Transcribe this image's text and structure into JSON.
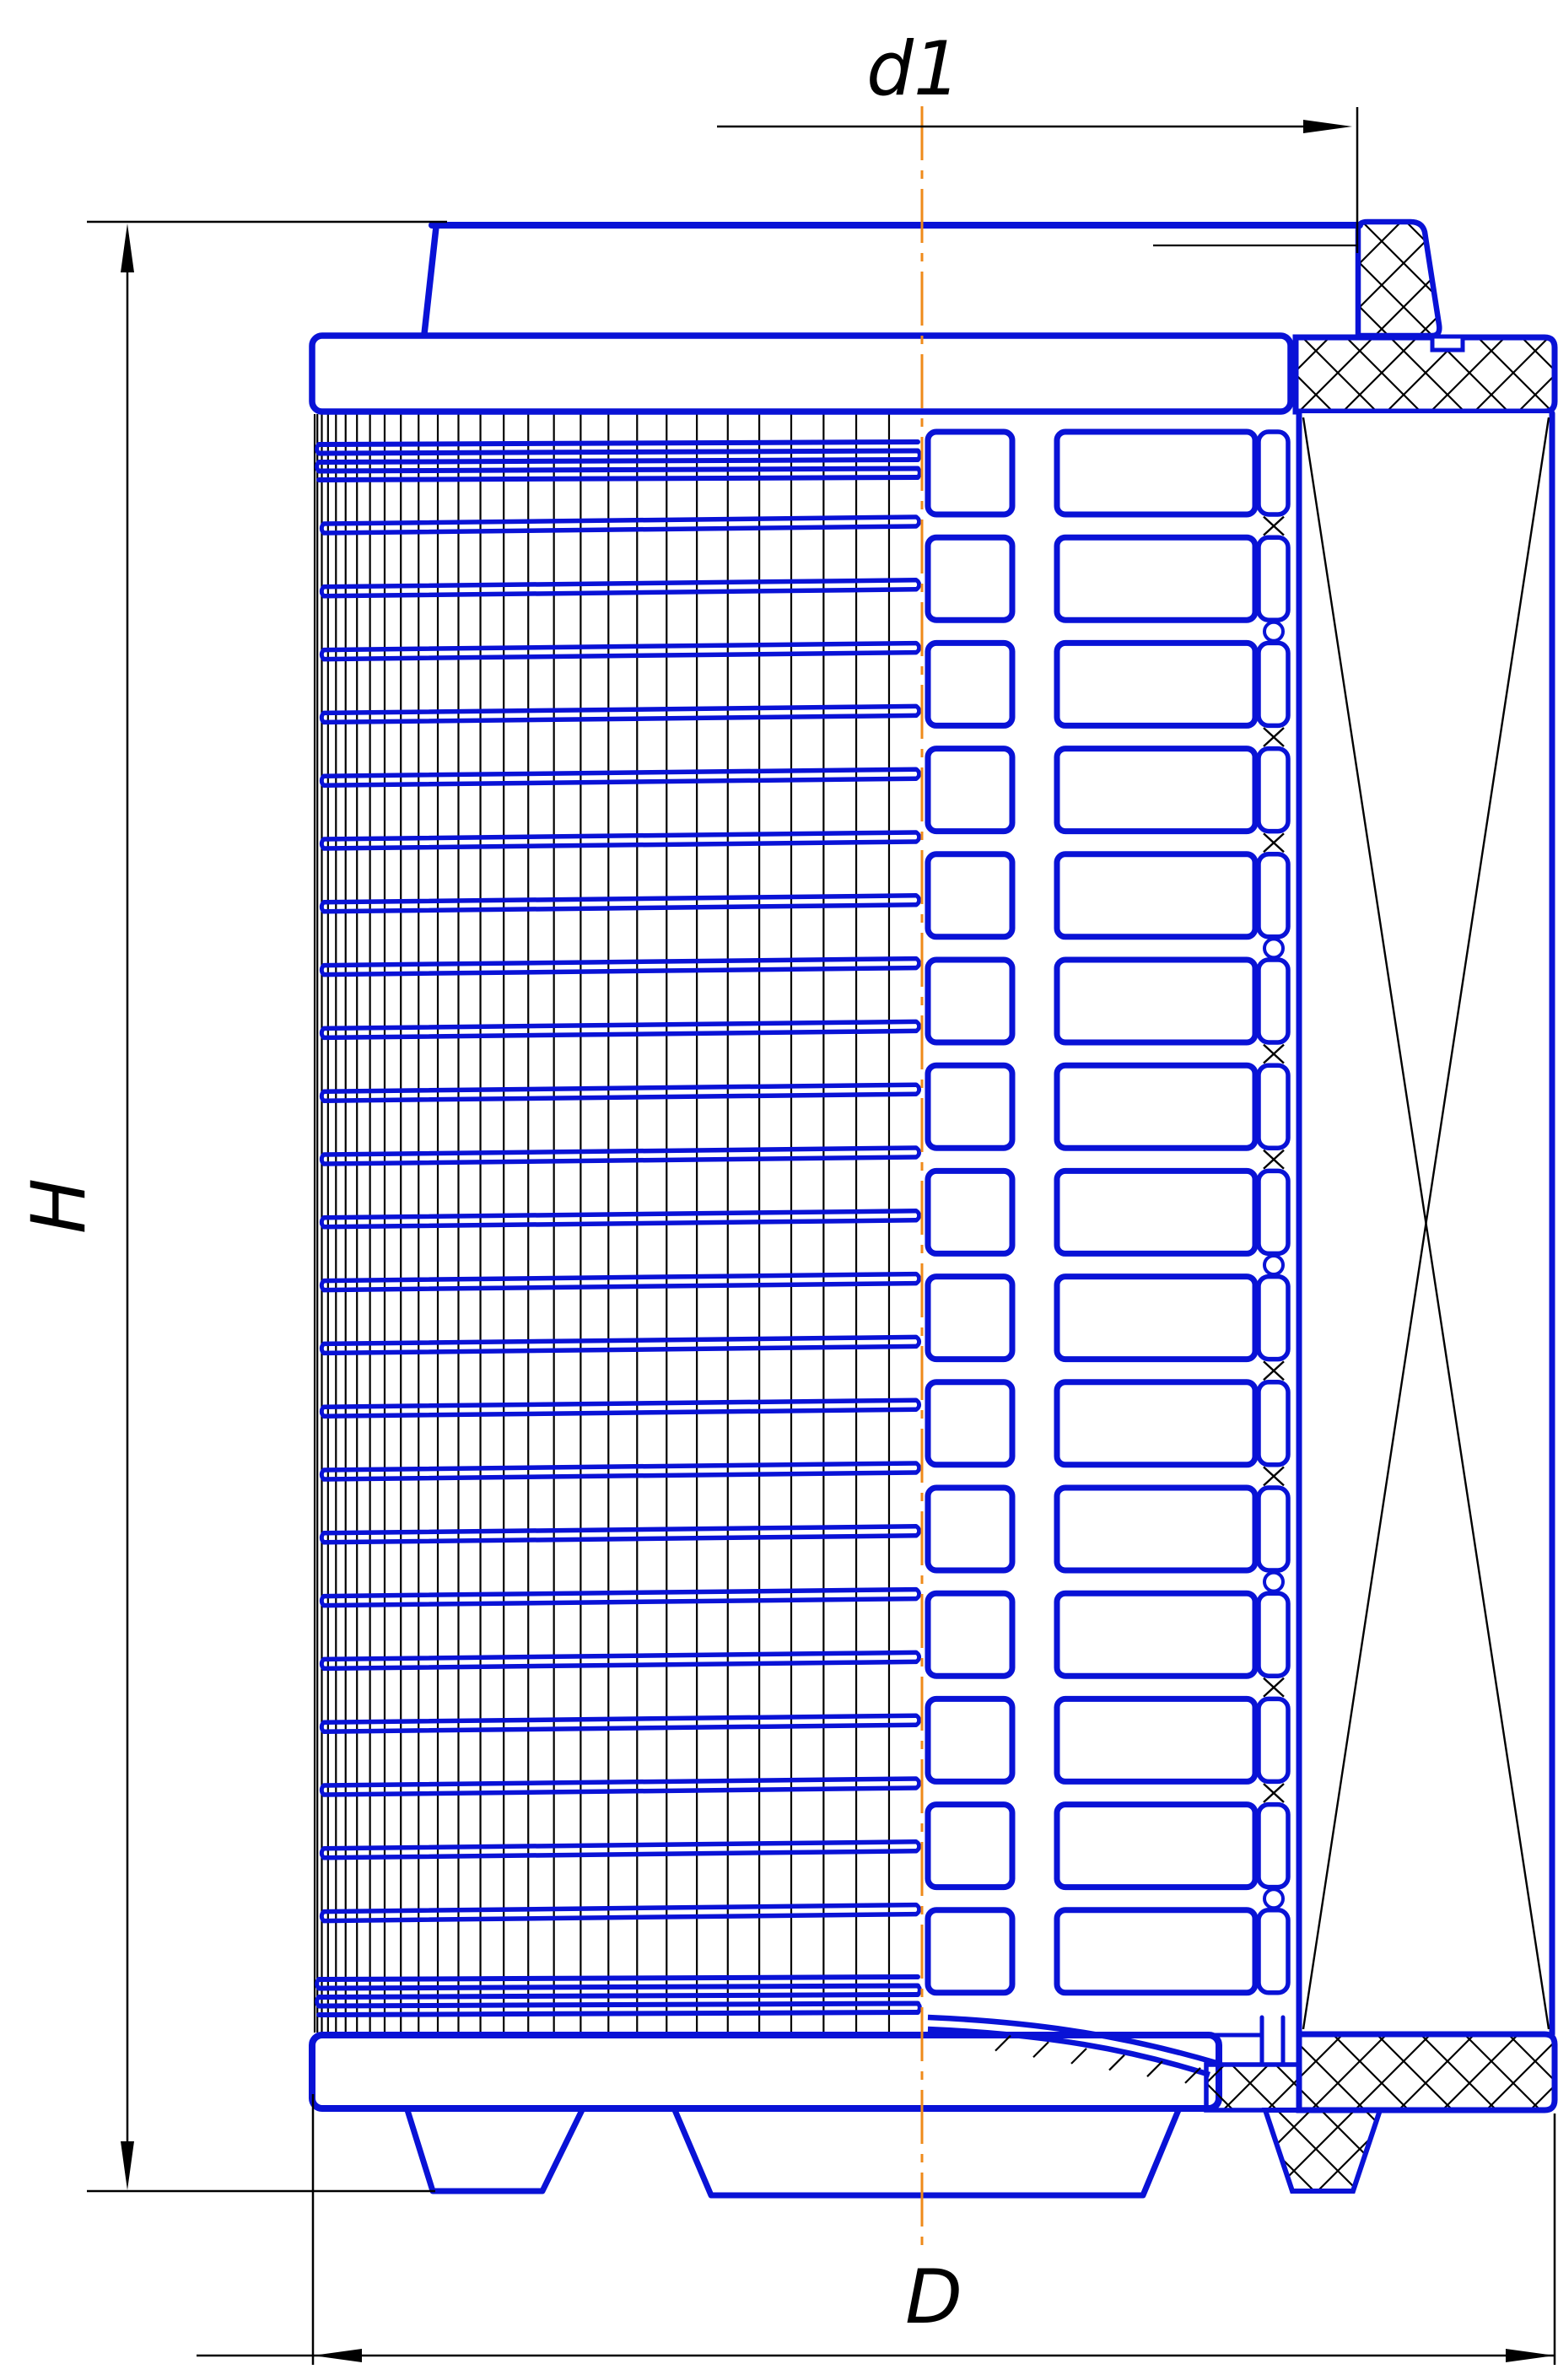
{
  "labels": {
    "height": "H",
    "top_inner_diameter": "d1",
    "outer_diameter": "D"
  },
  "colors": {
    "part_outline": "#0912d6",
    "dimension_lines": "#000000",
    "hatch": "#000000",
    "centerline": "#ef8a1a",
    "paper": "#ffffff"
  },
  "counts": {
    "pleat_rows": 15,
    "wire_wraps": 23,
    "mesh_generatrix_lines": 28,
    "top_bundle_turns": 5,
    "bottom_bundle_turns": 5
  }
}
